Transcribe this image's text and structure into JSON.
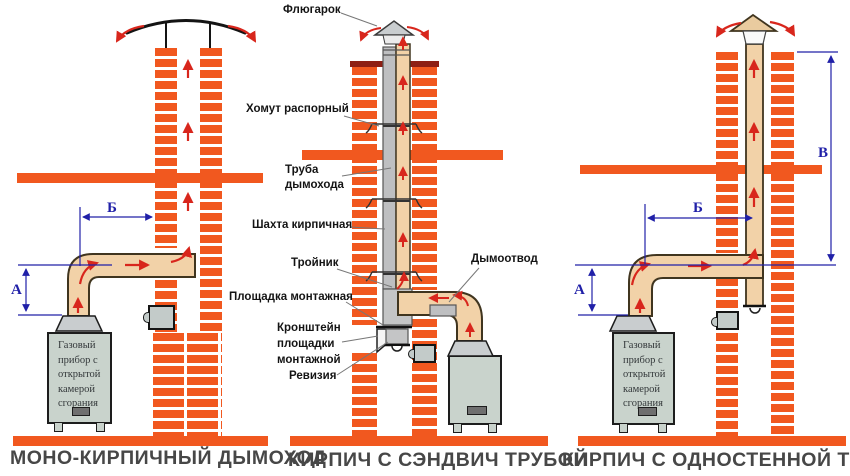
{
  "captions": {
    "left": "МОНО-КИРПИЧНЫЙ ДЫМОХОД",
    "middle": "КИРПИЧ С СЭНДВИЧ ТРУБОЙ",
    "right": "КИРПИЧ С ОДНОСТЕННОЙ ТРУБОЙ"
  },
  "boiler_label": "Газовый\nприбор с\nоткрытой\nкамерой\nсгорания",
  "part_labels": {
    "fluegarok": "Флюгарок",
    "khomut": "Хомут распорный",
    "truba": "Труба\nдымохода",
    "shahta": "Шахта кирпичная",
    "troynik": "Тройник",
    "ploshchadka": "Площадка монтажная",
    "kronshtein": "Кронштейн\nплощадки\nмонтажной",
    "reviziya": "Ревизия",
    "dymootvod": "Дымоотвод"
  },
  "dim_labels": {
    "a": "А",
    "b": "Б",
    "v": "В"
  },
  "colors": {
    "brick": "#F1581F",
    "chimney_crown": "#8E1F14",
    "pipe_beige": "#F2D2A8",
    "pipe_grey": "#BEBFC1",
    "metal_grey": "#C9CDCF",
    "boiler_body": "#C9D3CC",
    "dimension_blue": "#2020A8",
    "flow_arrow_red": "#D8261C"
  }
}
